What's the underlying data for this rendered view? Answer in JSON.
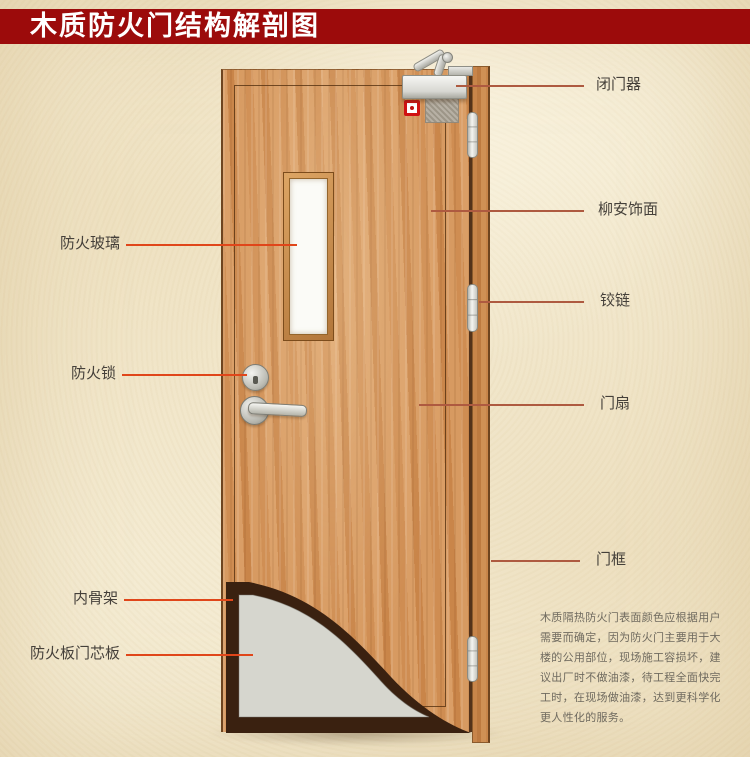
{
  "title": "木质防火门结构解剖图",
  "labels": {
    "right": [
      {
        "text": "闭门器"
      },
      {
        "text": "柳安饰面"
      },
      {
        "text": "铰链"
      },
      {
        "text": "门扇"
      },
      {
        "text": "门框"
      }
    ],
    "left": [
      {
        "text": "防火玻璃"
      },
      {
        "text": "防火锁"
      },
      {
        "text": "内骨架"
      },
      {
        "text": "防火板门芯板"
      }
    ]
  },
  "description": {
    "lines": [
      "木质隔热防火门表面颜色应根据用户",
      "需要而确定，因为防火门主要用于大",
      "楼的公用部位，现场施工容损坏，建",
      "议出厂时不做油漆，待工程全面快完",
      "工时，在现场做油漆，达到更科学化",
      "更人性化的服务。"
    ]
  },
  "colors": {
    "banner": "#9c0b0b",
    "wood_base": "#d2905a",
    "leader_left": "#e0461a",
    "leader_right": "#ae5a40",
    "skeleton_dark": "#3a2110",
    "core_grey": "#d6d6ce",
    "label_text": "#45403a",
    "paragraph_text": "#6f6a5f"
  }
}
